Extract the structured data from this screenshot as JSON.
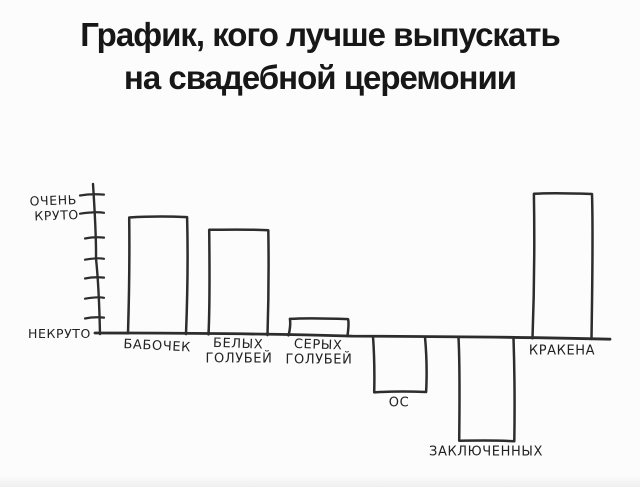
{
  "title": {
    "line1": "График, кого лучше выпускать",
    "line2": "на свадебной церемонии"
  },
  "chart_data": {
    "type": "bar",
    "title": "График, кого лучше выпускать на свадебной церемонии",
    "categories": [
      "БАБОЧЕК",
      "БЕЛЫХ ГОЛУБЕЙ",
      "СЕРЫХ ГОЛУБЕЙ",
      "ОС",
      "ЗАКЛЮЧЕННЫХ",
      "КРАКЕНА"
    ],
    "values": [
      5.8,
      5.2,
      0.8,
      -2.8,
      -5.2,
      7.2
    ],
    "ylim": [
      -5.5,
      7.5
    ],
    "grid": false,
    "legend": false,
    "y_axis": {
      "label_top": [
        "ОЧЕНЬ",
        "КРУТО"
      ],
      "label_zero": "НЕКРУТО",
      "tick_count": 7
    },
    "bars": [
      {
        "label_lines": [
          "БАБОЧЕК"
        ],
        "value": 5.8,
        "x_center": 157,
        "width": 58,
        "tilt": 3
      },
      {
        "label_lines": [
          "БЕЛЫХ",
          "ГОЛУБЕЙ"
        ],
        "value": 5.2,
        "x_center": 238,
        "width": 59,
        "tilt": 2
      },
      {
        "label_lines": [
          "СЕРЫХ",
          "ГОЛУБЕЙ"
        ],
        "value": 0.8,
        "x_center": 318,
        "width": 59,
        "tilt": 2
      },
      {
        "label_lines": [
          "ОС"
        ],
        "value": -2.8,
        "x_center": 399,
        "width": 52,
        "tilt": 0
      },
      {
        "label_lines": [
          "ЗАКЛЮЧЕННЫХ"
        ],
        "value": -5.2,
        "x_center": 486,
        "width": 55,
        "tilt": 0
      },
      {
        "label_lines": [
          "КРАКЕНА"
        ],
        "value": 7.2,
        "x_center": 562,
        "width": 59,
        "tilt": 0
      }
    ],
    "layout": {
      "axis_x": 95,
      "axis_top_y": 184,
      "baseline_y": 333,
      "baseline_slope": 0.012,
      "baseline_x_end": 610,
      "unit_px": 20,
      "tick_ys": [
        195,
        213,
        238,
        259,
        278,
        298,
        318
      ],
      "y_label_positions": {
        "top1": [
          77,
          204
        ],
        "top2": [
          79,
          219
        ],
        "zero": [
          91,
          338
        ]
      }
    }
  },
  "colors": {
    "background": "#fcfcfc",
    "ink": "#2d2d2d",
    "text": "#222222",
    "title": "#171717"
  }
}
